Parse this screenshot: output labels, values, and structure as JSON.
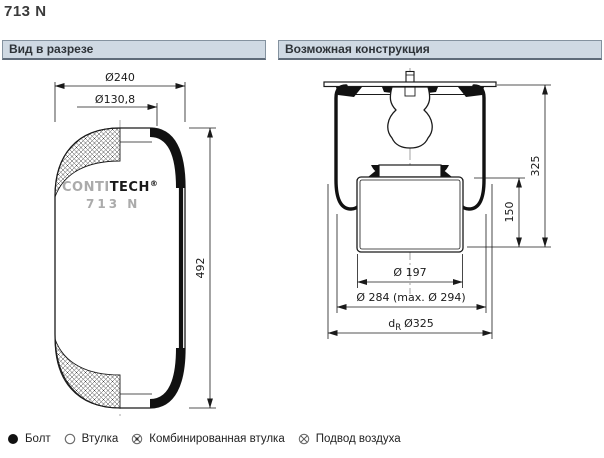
{
  "page": {
    "title": "713 N"
  },
  "panels": {
    "left": {
      "header": "Вид в разрезе"
    },
    "right": {
      "header": "Возможная конструкция"
    }
  },
  "left_drawing": {
    "dim_d240": "Ø240",
    "dim_d130": "Ø130,8",
    "dim_height": "492",
    "logo_conti": "CONTI",
    "logo_tech": "TECH",
    "logo_reg": "®",
    "logo_model": "713 N"
  },
  "right_drawing": {
    "dim_h325": "325",
    "dim_h150": "150",
    "dim_d197": "Ø 197",
    "dim_d284": "Ø 284 (max. Ø 294)",
    "dim_dr_d": "d",
    "dim_dr_sub": "R",
    "dim_dr_val": "Ø325"
  },
  "legend": {
    "items": [
      {
        "icon": "bolt-icon",
        "label": "Болт"
      },
      {
        "icon": "bushing-icon",
        "label": "Втулка"
      },
      {
        "icon": "combined-bushing-icon",
        "label": "Комбинированная втулка"
      },
      {
        "icon": "air-port-icon",
        "label": "Подвод воздуха"
      }
    ]
  },
  "colors": {
    "header_bg": "#cfd9e3",
    "header_border": "#84929f",
    "line": "#1a1a1a",
    "centerline": "#9a9a9a",
    "logo_gray": "#ababab"
  }
}
